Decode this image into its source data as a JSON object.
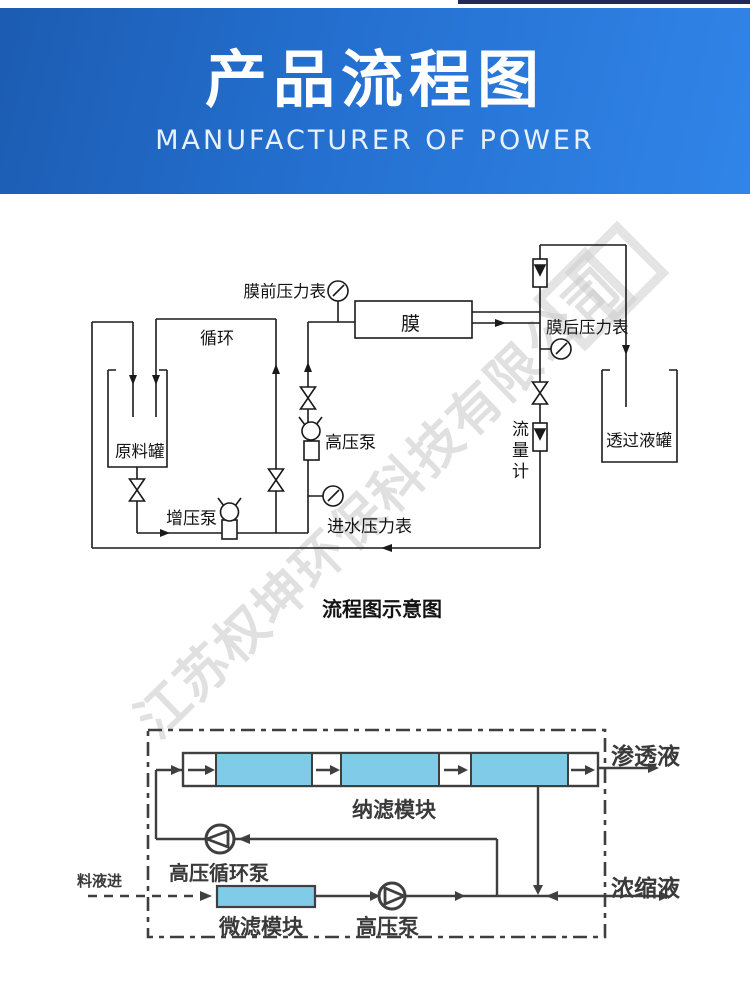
{
  "header": {
    "title": "产品流程图",
    "subtitle": "MANUFACTURER OF POWER"
  },
  "watermark": {
    "text": "江苏权坤环保科技有限公司"
  },
  "diagram1": {
    "caption": "流程图示意图",
    "labels": {
      "pre_membrane_gauge": "膜前压力表",
      "circulation": "循环",
      "raw_tank": "原料罐",
      "booster_pump": "增压泵",
      "high_pressure_pump": "高压泵",
      "inlet_gauge": "进水压力表",
      "membrane": "膜",
      "post_membrane_gauge": "膜后压力表",
      "flow_meter": "流量计",
      "permeate_tank": "透过液罐"
    }
  },
  "diagram2": {
    "labels": {
      "nf_module": "纳滤模块",
      "permeate": "渗透液",
      "concentrate": "浓缩液",
      "hp_circulation_pump": "高压循环泵",
      "feed_in": "料液进",
      "mf_module": "微滤模块",
      "high_pressure_pump": "高压泵"
    }
  },
  "colors": {
    "banner_start": "#1c5cb2",
    "banner_end": "#3185e8",
    "module_blue": "#7fcbe8",
    "line_black": "#1a1a1a",
    "line_gray": "#3f3f3f"
  }
}
